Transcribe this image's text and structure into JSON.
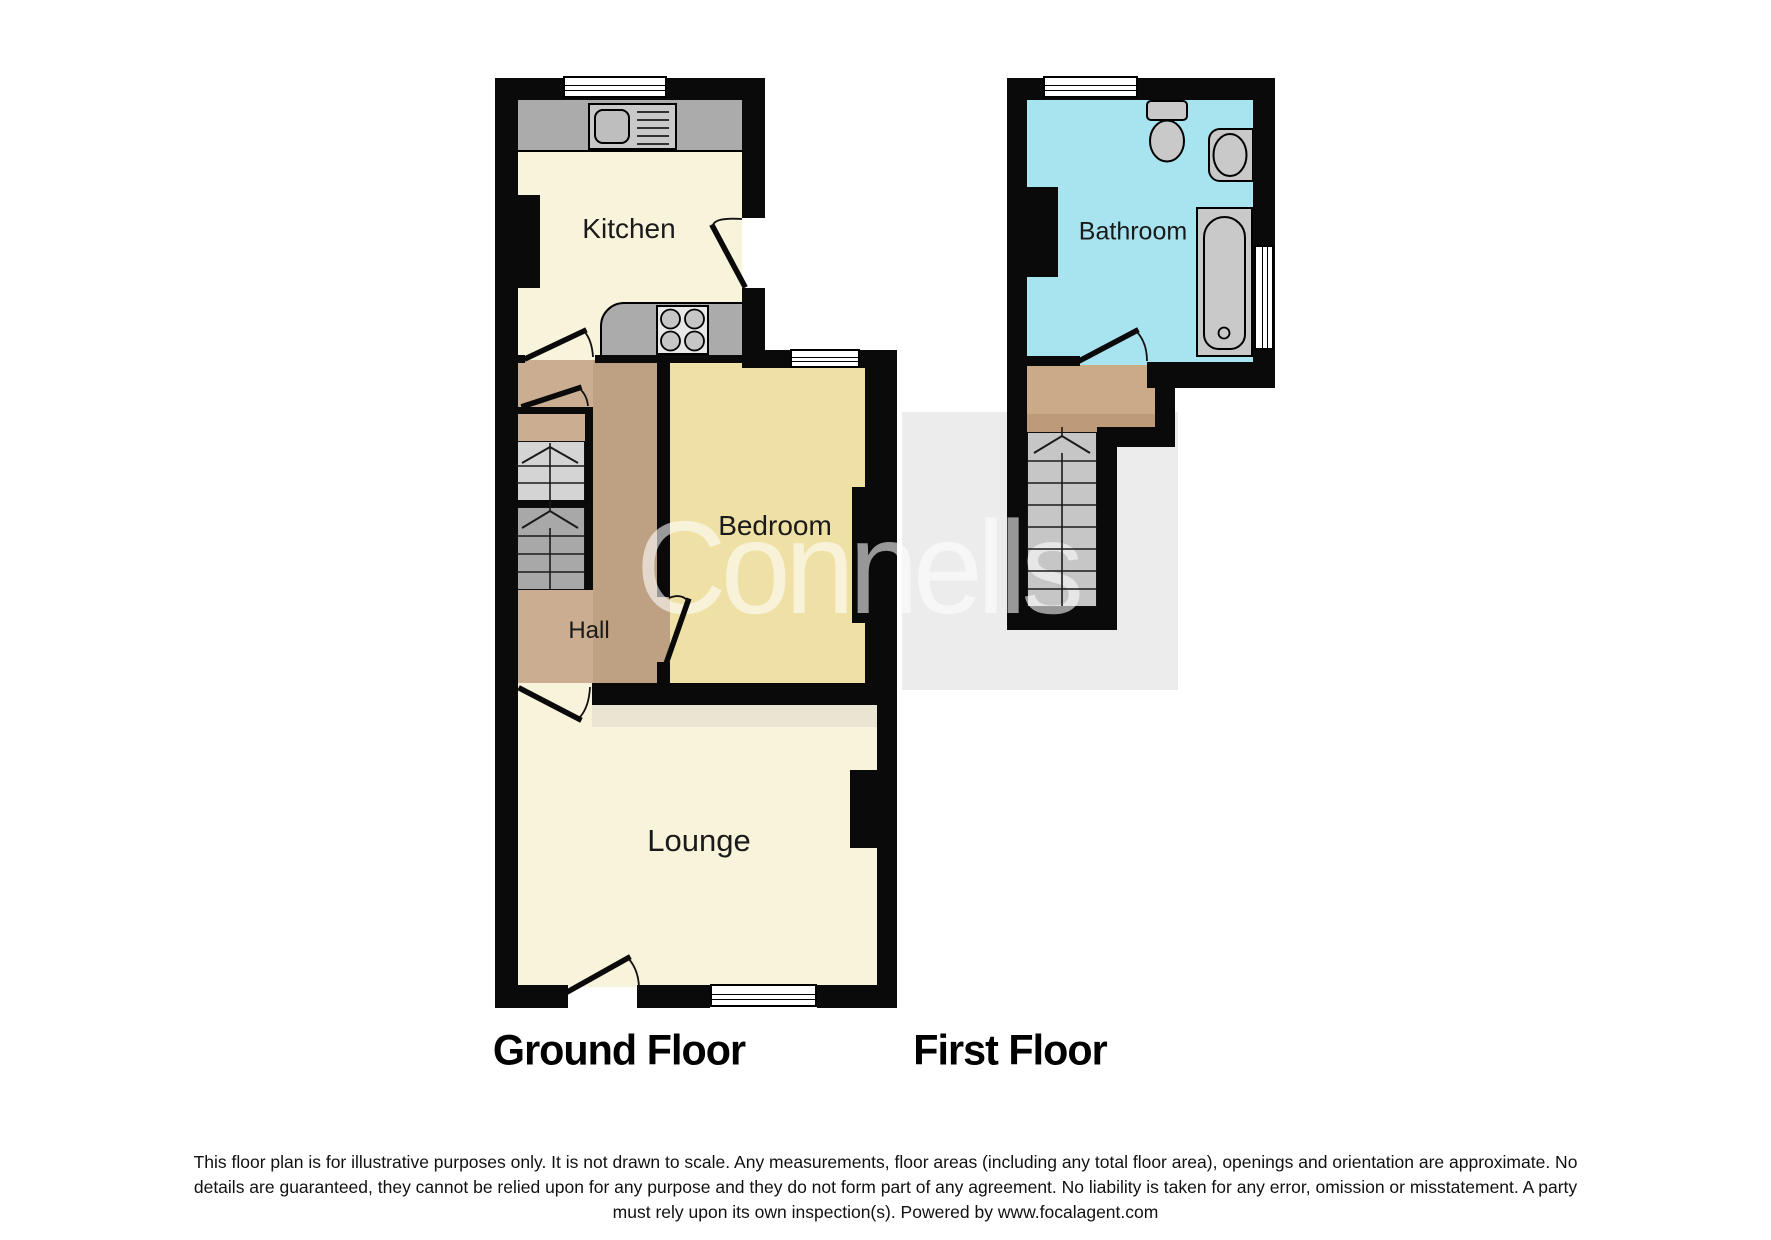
{
  "rooms": {
    "kitchen": "Kitchen",
    "bedroom": "Bedroom",
    "hall": "Hall",
    "lounge": "Lounge",
    "bathroom": "Bathroom"
  },
  "floor_titles": {
    "ground": "Ground Floor",
    "first": "First Floor"
  },
  "watermark": {
    "text": "Connells"
  },
  "disclaimer": {
    "lines": [
      "This floor plan is for illustrative purposes only. It is not drawn to scale. Any measurements, floor areas (including any total floor area), openings and orientation are approximate. No",
      "details are guaranteed, they cannot be relied upon for any purpose and they do not form part of any agreement. No liability is taken for any error, omission or misstatement. A party",
      "must rely upon its own inspection(s). Powered by www.focalagent.com"
    ]
  },
  "colors": {
    "wall": "#0A0A0A",
    "kitchen_floor": "#F8F3DB",
    "lounge_floor": "#F8F3DB",
    "lounge_top_strip": "#E9E5D2",
    "bedroom_floor": "#EFE0A5",
    "hall_floor_dark": "#BEA183",
    "hall_floor_light": "#CBAE92",
    "landing_floor": "#CBAA88",
    "landing_floor_dark": "#BD9B79",
    "bathroom_floor": "#A8E3F0",
    "stairs_upper": "#D4D4D4",
    "stairs_lower": "#A8A8A8",
    "stairs_first_floor": "#C6C6C6",
    "fixture_gray": "#C9C9C9",
    "counter_gray": "#ABABAB",
    "watermark_band": "#ECECEC"
  }
}
